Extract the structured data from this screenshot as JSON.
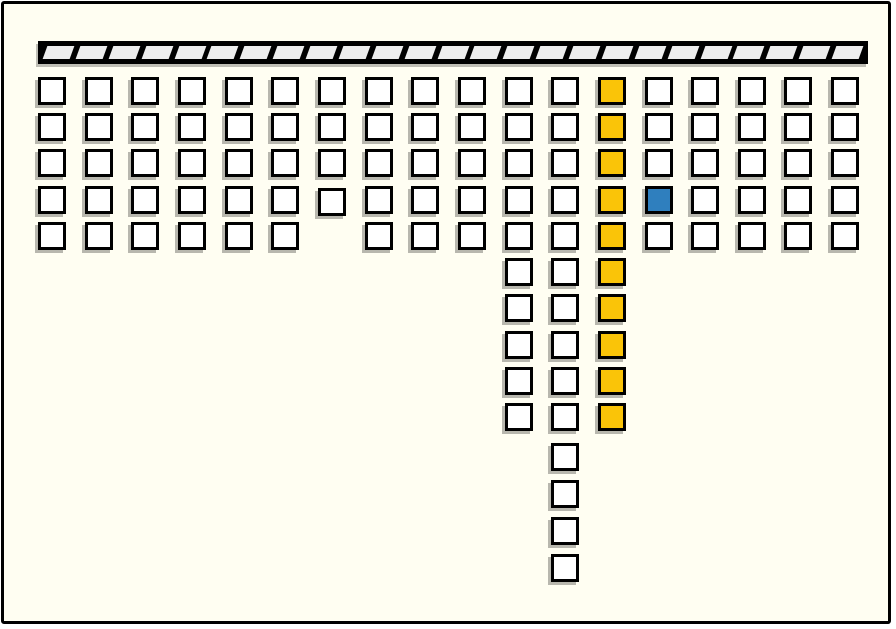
{
  "canvas": {
    "width": 896,
    "height": 629,
    "background": "#FFFEF2",
    "frame_color": "#000000"
  },
  "ceiling_bar": {
    "x": 35,
    "y": 41,
    "width": 830,
    "height": 23,
    "segment_count": 25,
    "segment_fill": "#EDEDED",
    "outline_color": "#000000"
  },
  "grid": {
    "square_size": 28,
    "border_color": "#000000",
    "colors": {
      "white": "#FFFFFF",
      "yellow": "#FAC408",
      "blue": "#2F7FBE"
    },
    "col_x": [
      38,
      85,
      131,
      178,
      225,
      271,
      318,
      365,
      411,
      458,
      505,
      551,
      598,
      645,
      691,
      738,
      784,
      831
    ],
    "row_y": [
      77,
      113,
      149,
      186,
      222,
      258,
      294,
      331,
      367,
      403,
      443,
      480,
      517,
      554
    ],
    "cells": [
      {
        "row": 1,
        "cols": [
          1,
          2,
          3,
          4,
          5,
          6,
          7,
          8,
          9,
          10,
          11,
          12
        ],
        "color": "white"
      },
      {
        "row": 1,
        "cols": [
          13
        ],
        "color": "yellow"
      },
      {
        "row": 1,
        "cols": [
          14,
          15,
          16,
          17,
          18
        ],
        "color": "white"
      },
      {
        "row": 2,
        "cols": [
          1,
          2,
          3,
          4,
          5,
          6,
          7,
          8,
          9,
          10,
          11,
          12
        ],
        "color": "white"
      },
      {
        "row": 2,
        "cols": [
          13
        ],
        "color": "yellow"
      },
      {
        "row": 2,
        "cols": [
          14,
          15,
          16,
          17,
          18
        ],
        "color": "white"
      },
      {
        "row": 3,
        "cols": [
          1,
          2,
          3,
          4,
          5,
          6,
          7,
          8,
          9,
          10,
          11,
          12
        ],
        "color": "white"
      },
      {
        "row": 3,
        "cols": [
          13
        ],
        "color": "yellow"
      },
      {
        "row": 3,
        "cols": [
          14,
          15,
          16,
          17,
          18
        ],
        "color": "white"
      },
      {
        "row": 4,
        "cols": [
          1,
          2,
          3,
          4,
          5,
          6
        ],
        "color": "white"
      },
      {
        "row": 4,
        "cols": [
          7
        ],
        "color": "white",
        "dy": 2
      },
      {
        "row": 4,
        "cols": [
          8,
          9,
          10,
          11,
          12
        ],
        "color": "white"
      },
      {
        "row": 4,
        "cols": [
          13
        ],
        "color": "yellow"
      },
      {
        "row": 4,
        "cols": [
          14
        ],
        "color": "blue"
      },
      {
        "row": 4,
        "cols": [
          15,
          16,
          17,
          18
        ],
        "color": "white"
      },
      {
        "row": 5,
        "cols": [
          1,
          2,
          3,
          4,
          5,
          6,
          8,
          9,
          10,
          11,
          12
        ],
        "color": "white"
      },
      {
        "row": 5,
        "cols": [
          13
        ],
        "color": "yellow"
      },
      {
        "row": 5,
        "cols": [
          14,
          15,
          16,
          17,
          18
        ],
        "color": "white"
      },
      {
        "row": 6,
        "cols": [
          11,
          12
        ],
        "color": "white"
      },
      {
        "row": 6,
        "cols": [
          13
        ],
        "color": "yellow"
      },
      {
        "row": 7,
        "cols": [
          11,
          12
        ],
        "color": "white"
      },
      {
        "row": 7,
        "cols": [
          13
        ],
        "color": "yellow"
      },
      {
        "row": 8,
        "cols": [
          11,
          12
        ],
        "color": "white"
      },
      {
        "row": 8,
        "cols": [
          13
        ],
        "color": "yellow"
      },
      {
        "row": 9,
        "cols": [
          11,
          12
        ],
        "color": "white"
      },
      {
        "row": 9,
        "cols": [
          13
        ],
        "color": "yellow"
      },
      {
        "row": 10,
        "cols": [
          11,
          12
        ],
        "color": "white"
      },
      {
        "row": 10,
        "cols": [
          13
        ],
        "color": "yellow"
      },
      {
        "row": 11,
        "cols": [
          12
        ],
        "color": "white"
      },
      {
        "row": 12,
        "cols": [
          12
        ],
        "color": "white"
      },
      {
        "row": 13,
        "cols": [
          12
        ],
        "color": "white"
      },
      {
        "row": 14,
        "cols": [
          12
        ],
        "color": "white"
      }
    ]
  }
}
